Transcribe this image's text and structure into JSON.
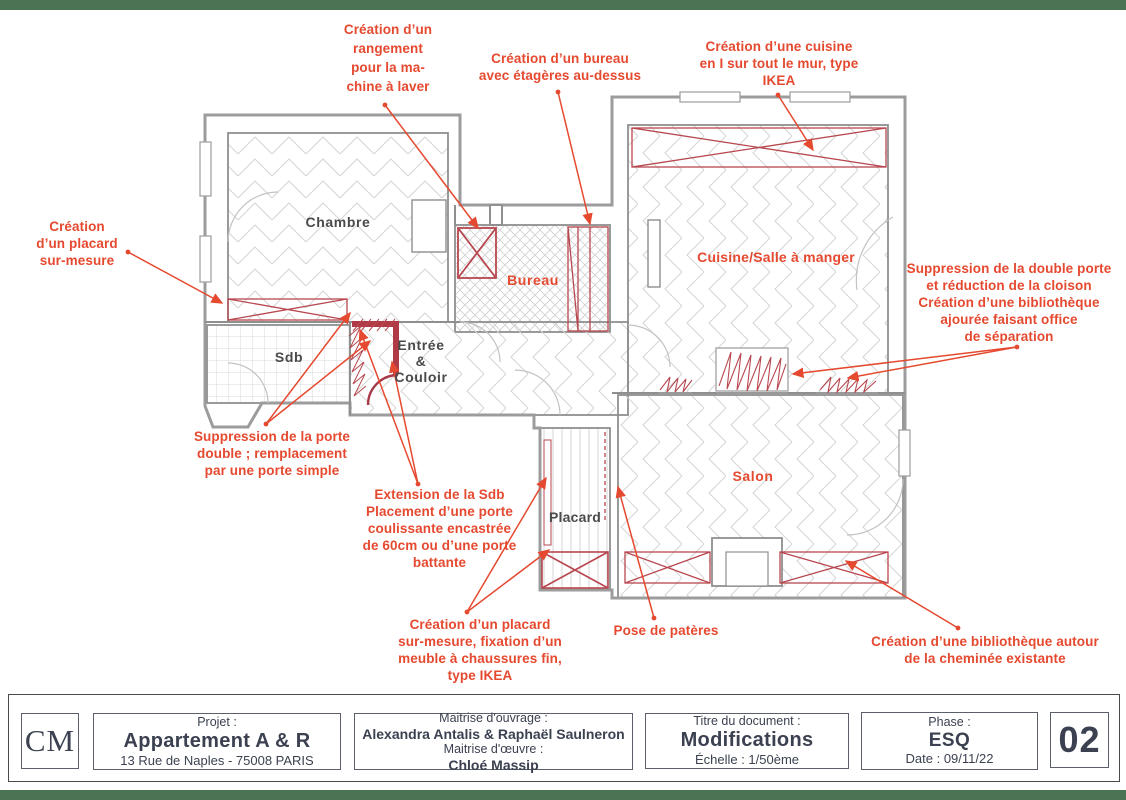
{
  "page": {
    "accent_border_color": "#4d7355"
  },
  "plan": {
    "rooms": {
      "chambre": {
        "label": "Chambre"
      },
      "bureau": {
        "label": "Bureau"
      },
      "cuisine": {
        "label": "Cuisine/Salle à manger"
      },
      "sdb": {
        "label": "Sdb"
      },
      "entree": {
        "label": "Entrée\n&\nCouloir"
      },
      "placard": {
        "label": "Placard"
      },
      "salon": {
        "label": "Salon"
      }
    },
    "annotations": {
      "machine_a_laver": {
        "text": "Création d’un\nrangement\npour la ma-\nchine à laver"
      },
      "bureau_etageres": {
        "text": "Création d’un bureau\navec étagères au-dessus"
      },
      "cuisine_ikea": {
        "text": "Création d’une cuisine\nen I sur tout le mur, type\nIKEA"
      },
      "placard_sur_mesure": {
        "text": "Création\nd’un placard\nsur-mesure"
      },
      "double_porte_cloison": {
        "text": "Suppression de la double porte\net réduction de la cloison\nCréation d’une bibliothèque\najourée faisant office\nde séparation"
      },
      "porte_simple": {
        "text": "Suppression de la porte\ndouble ; remplacement\npar une porte simple"
      },
      "extension_sdb": {
        "text": "Extension de la Sdb\nPlacement d’une porte\ncoulissante encastrée\nde 60cm ou d’une porte\nbattante"
      },
      "placard_chaussures": {
        "text": "Création d’un placard\nsur-mesure, fixation d’un\nmeuble à chaussures fin,\ntype IKEA"
      },
      "pateres": {
        "text": "Pose de patères"
      },
      "bibliotheque_cheminee": {
        "text": "Création d’une bibliothèque autour\nde la cheminée existante"
      }
    },
    "colors": {
      "annotation_red": "#e5492f",
      "plan_mark_red": "#b8474f",
      "wall_gray": "#8f8f8f"
    }
  },
  "title_block": {
    "logo": "CM",
    "project": {
      "label": "Projet :",
      "name": "Appartement A & R",
      "address": "13 Rue de Naples - 75008 PARIS"
    },
    "maitrise": {
      "ouvrage_label": "Maitrise d'ouvrage :",
      "ouvrage_name": "Alexandra Antalis & Raphaël Saulneron",
      "oeuvre_label": "Maitrise d'œuvre :",
      "oeuvre_name": "Chloé Massip"
    },
    "document": {
      "label": "Titre du document :",
      "title": "Modifications",
      "scale": "Échelle : 1/50ème"
    },
    "phase": {
      "label": "Phase :",
      "value": "ESQ",
      "date": "Date : 09/11/22"
    },
    "sheet_number": "02"
  }
}
